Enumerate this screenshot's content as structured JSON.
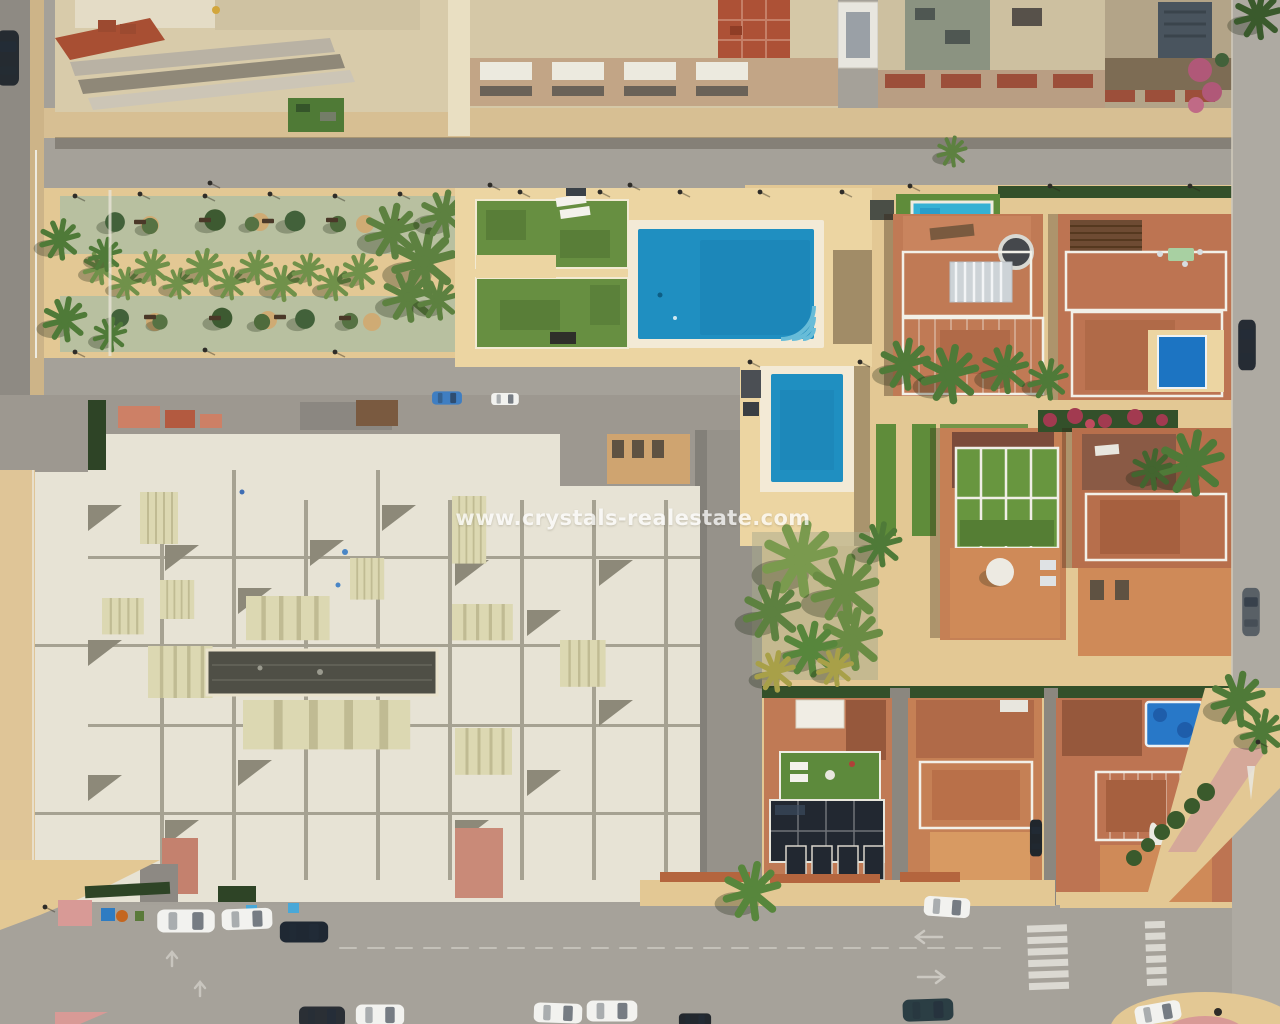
{
  "watermark": {
    "text": "www.crystals-realestate.com"
  },
  "scene": {
    "type": "aerial-drone-photo",
    "description": "Top-down aerial view of a Mediterranean residential block: apartment buildings along the top, a linear palm-tree park, a communal pool area with two blue pools and lawns, a large cream rooftop apartment complex, a row of terracotta villas with private pools and solar panels, and streets with parked cars, road arrows and a zebra crossing",
    "features": [
      "apartment-rooftops",
      "linear-palm-park",
      "communal-pool",
      "secondary-pool",
      "white-apartment-complex",
      "villa-row",
      "covered-pool",
      "jacuzzi",
      "solar-panels",
      "streets-with-parked-cars",
      "zebra-crossing",
      "road-arrows"
    ]
  },
  "colors": {
    "asphalt": "#a5a199",
    "asphalt-dark": "#8e8a83",
    "sand": "#e3c894",
    "deck": "#ecd5a2",
    "apron": "#f3ead6",
    "pool-blue": "#1f8fc1",
    "pool-steps": "#67bcd8",
    "pool-cover": "#35b1d4",
    "small-pool": "#1c74c2",
    "lawn": "#678f41",
    "turf": "#5f8c3a",
    "park-green": "#b8c0a0",
    "palm": "#70914a",
    "tree-dark": "#42613a",
    "hedge": "#33502a",
    "roof-cream": "#e7e3d5",
    "roof-beige": "#d8cbaa",
    "terracotta": "#c07a55",
    "terracotta-dark": "#9b5f43",
    "tile-red": "#ad5136",
    "brown-roof": "#7b4b3a",
    "slate": "#49545e",
    "bougainvillea": "#b05878",
    "solar": "#222831",
    "car-white": "#f2f2ef",
    "car-dark": "#252b31",
    "pink-pavement": "#d2a29a",
    "marking": "#e9e7e1",
    "watermark-color": "#ffffff"
  }
}
